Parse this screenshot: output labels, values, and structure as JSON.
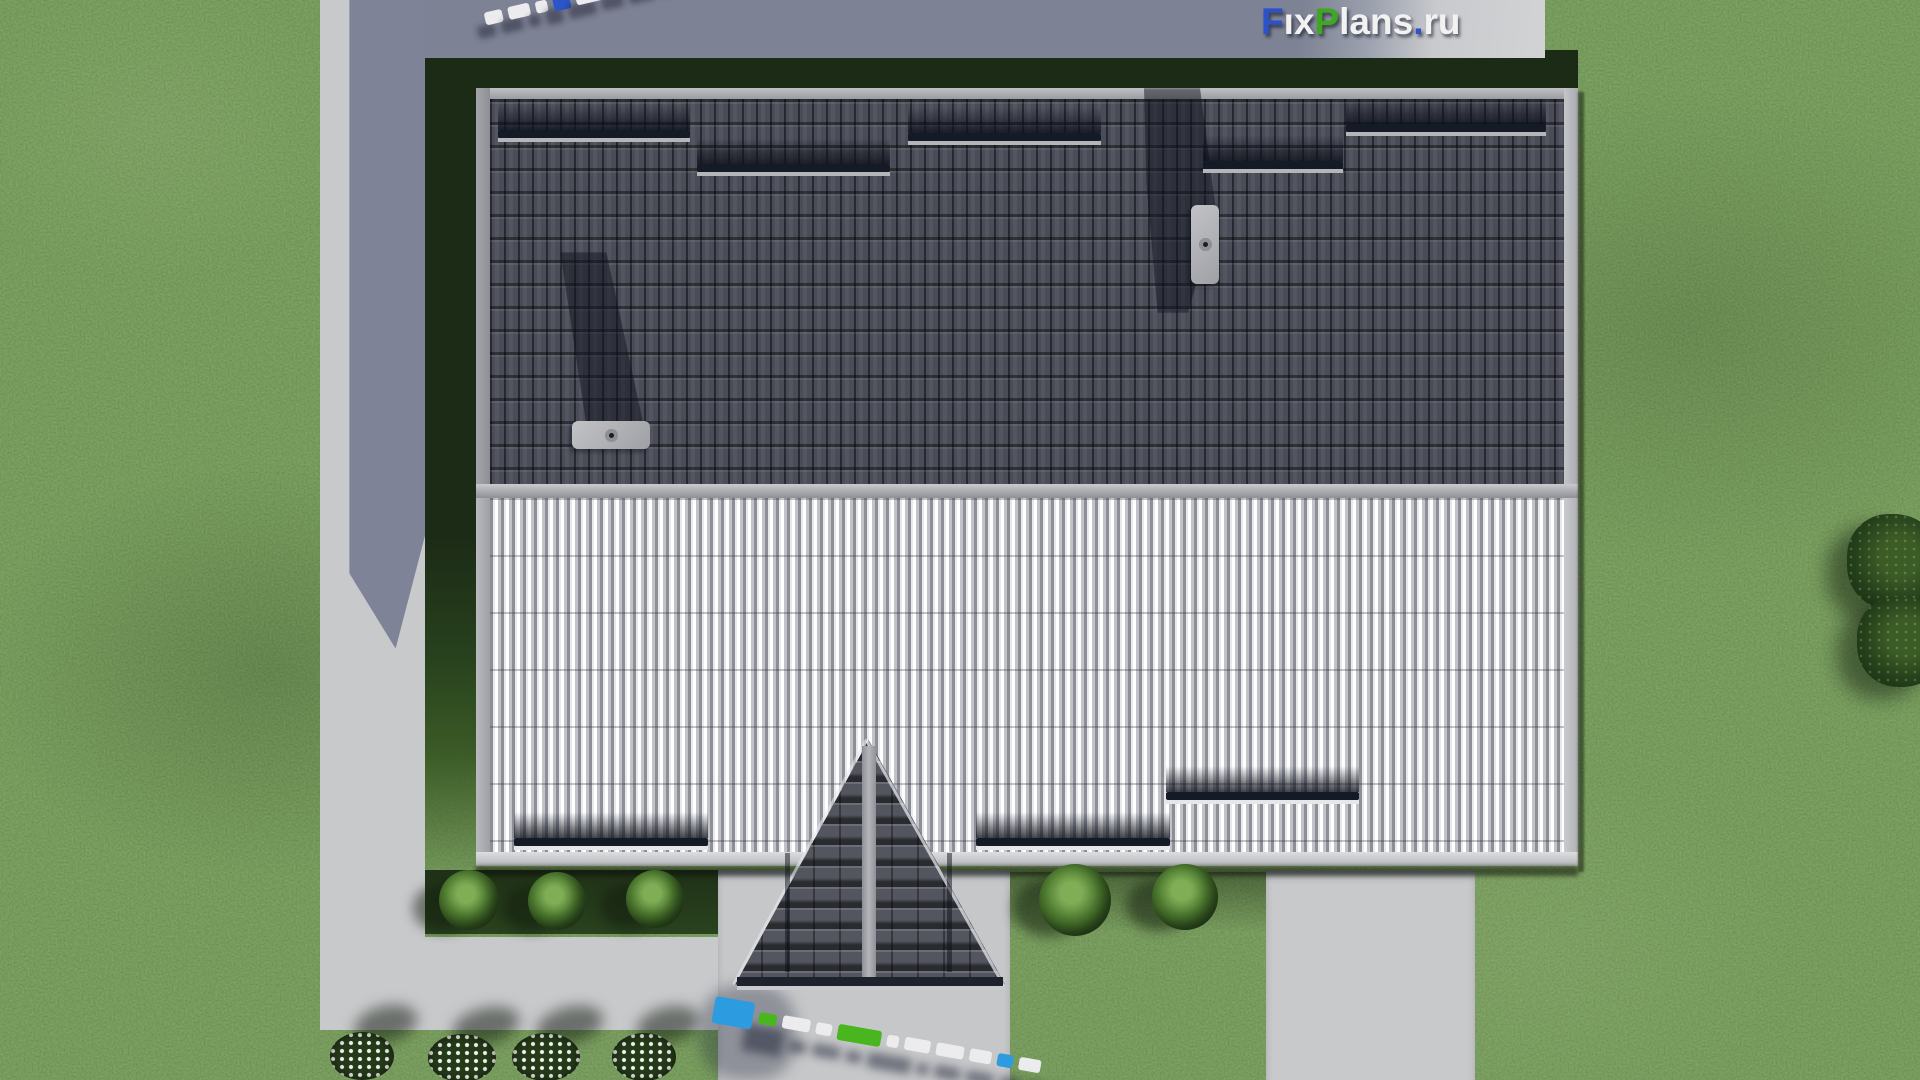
{
  "logo": {
    "text": "FixPlans.ru",
    "segments": [
      {
        "t": "F",
        "color": "#2b52c8"
      },
      {
        "t": "i",
        "color": "#f2f2f3",
        "dot": "#3ea81f"
      },
      {
        "t": "x",
        "color": "#f2f2f3"
      },
      {
        "t": "P",
        "color": "#3ea81f"
      },
      {
        "t": "lans",
        "color": "#f2f2f3"
      },
      {
        "t": ".",
        "color": "#2b52c8"
      },
      {
        "t": "ru",
        "color": "#f2f2f3"
      }
    ]
  },
  "scene": {
    "description": "Top-down 3D architectural render of a gable-roof house with lawn, L-shaped concrete walkway, entrance porch and driveway",
    "colors": {
      "grass": "#4d6831",
      "grass_shadow": "#1c2b16",
      "concrete": "#c8c9cb",
      "concrete_shadow": "#7d8294",
      "roof_dark_tiles": "#4a4d58",
      "roof_light_ribbed": "#d6d7da",
      "ridge": "#adaeb3",
      "porch_tiles": "#53565f",
      "snow_guard": "#141a26",
      "chimney_cap": "#b5b6ba"
    },
    "snow_guards_dark": [
      {
        "x": 498,
        "y": 130,
        "w": 192
      },
      {
        "x": 697,
        "y": 164,
        "w": 193
      },
      {
        "x": 908,
        "y": 133,
        "w": 193
      },
      {
        "x": 1203,
        "y": 161,
        "w": 140
      },
      {
        "x": 1346,
        "y": 124,
        "w": 200
      }
    ],
    "snow_guards_light": [
      {
        "x": 514,
        "y": 838,
        "w": 194
      },
      {
        "x": 976,
        "y": 838,
        "w": 194
      },
      {
        "x": 1166,
        "y": 792,
        "w": 193
      }
    ],
    "chimneys": [
      {
        "x": 572,
        "y": 421,
        "w": 78,
        "h": 28,
        "pipes": 3,
        "orientation": "horizontal"
      },
      {
        "x": 1191,
        "y": 205,
        "w": 28,
        "h": 79,
        "pipes": 3,
        "orientation": "vertical"
      }
    ],
    "bushes": [
      {
        "cx": 469,
        "cy": 900,
        "r": 30
      },
      {
        "cx": 557,
        "cy": 901,
        "r": 29
      },
      {
        "cx": 655,
        "cy": 899,
        "r": 29
      },
      {
        "cx": 1075,
        "cy": 900,
        "r": 36
      },
      {
        "cx": 1185,
        "cy": 897,
        "r": 33
      }
    ],
    "flower_beds": [
      {
        "cx": 362,
        "cy": 1056,
        "rx": 32,
        "ry": 24
      },
      {
        "cx": 462,
        "cy": 1058,
        "rx": 34,
        "ry": 24
      },
      {
        "cx": 546,
        "cy": 1057,
        "rx": 34,
        "ry": 24
      },
      {
        "cx": 644,
        "cy": 1057,
        "rx": 32,
        "ry": 24
      }
    ],
    "trees": [
      {
        "cx": 1895,
        "cy": 562,
        "r": 48
      },
      {
        "cx": 1902,
        "cy": 642,
        "r": 45
      }
    ],
    "palette": {
      "white": "#ececee",
      "blue_bright": "#2d9be0",
      "blue_deep": "#2b55c8",
      "green": "#49b51f"
    },
    "watermarks": [
      {
        "id": "top",
        "x": 482,
        "y": 6,
        "rotation": -13,
        "shadow": "-10px 12px 6px rgba(18,22,38,0.42)",
        "blocks": [
          {
            "w": 18,
            "h": 13,
            "color": "white"
          },
          {
            "w": 22,
            "h": 13,
            "color": "white"
          },
          {
            "w": 12,
            "h": 12,
            "color": "white"
          },
          {
            "w": 17,
            "h": 16,
            "color": "blue_deep"
          },
          {
            "w": 28,
            "h": 14,
            "color": "white"
          },
          {
            "w": 22,
            "h": 13,
            "color": "white"
          },
          {
            "w": 26,
            "h": 13,
            "color": "white"
          },
          {
            "w": 10,
            "h": 12,
            "color": "white"
          },
          {
            "w": 34,
            "h": 15,
            "color": "green"
          },
          {
            "w": 20,
            "h": 13,
            "color": "white"
          }
        ]
      },
      {
        "id": "bottom",
        "x": 716,
        "y": 996,
        "rotation": 10,
        "shadow": "34px 22px 9px rgba(22,28,48,0.48)",
        "blocks": [
          {
            "w": 40,
            "h": 27,
            "color": "blue_bright"
          },
          {
            "w": 18,
            "h": 12,
            "color": "green"
          },
          {
            "w": 28,
            "h": 13,
            "color": "white"
          },
          {
            "w": 16,
            "h": 12,
            "color": "white"
          },
          {
            "w": 44,
            "h": 16,
            "color": "green"
          },
          {
            "w": 12,
            "h": 12,
            "color": "white"
          },
          {
            "w": 26,
            "h": 13,
            "color": "white"
          },
          {
            "w": 28,
            "h": 13,
            "color": "white"
          },
          {
            "w": 22,
            "h": 13,
            "color": "white"
          },
          {
            "w": 16,
            "h": 13,
            "color": "blue_bright"
          },
          {
            "w": 22,
            "h": 13,
            "color": "white"
          }
        ]
      }
    ]
  }
}
